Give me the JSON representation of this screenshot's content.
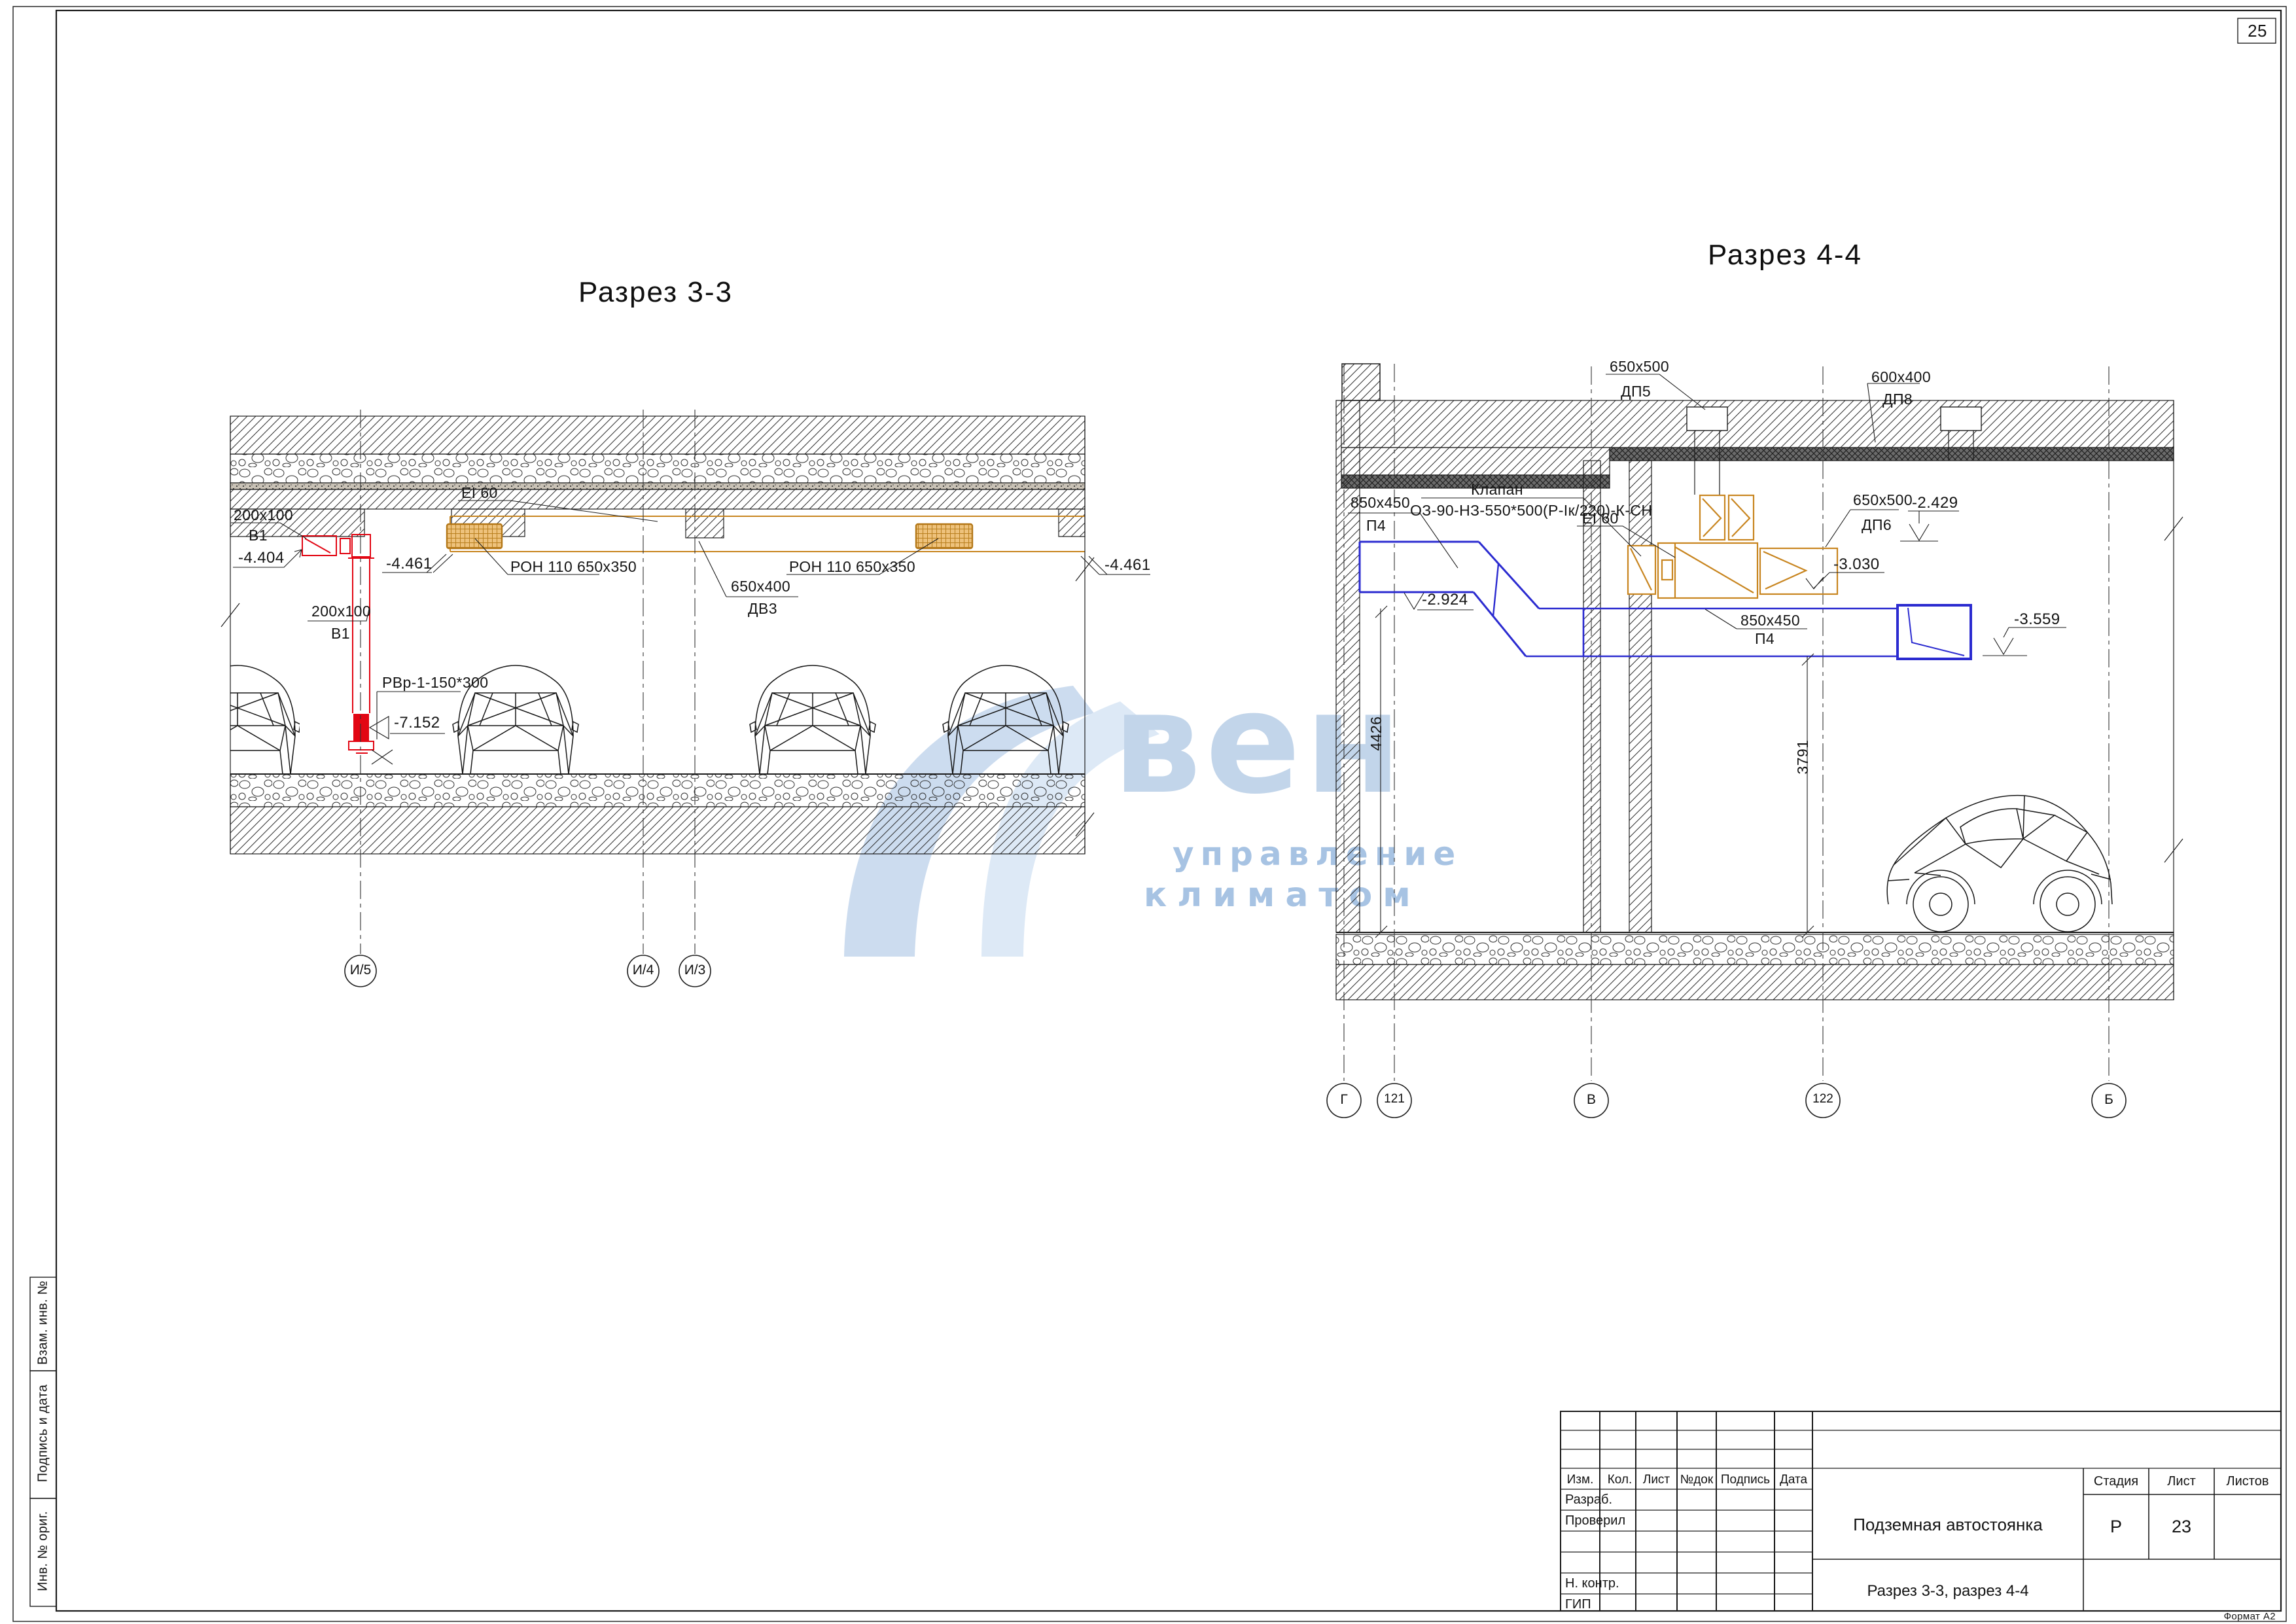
{
  "page": {
    "num": "25",
    "format": "Формат А2"
  },
  "margin": {
    "items": [
      "Взам. инв. №",
      "Подпись и дата",
      "Инв. № ориг."
    ]
  },
  "watermark": {
    "big": "вен",
    "line1": "управление",
    "line2": "климатом"
  },
  "s33": {
    "title": "Разрез 3-3",
    "duct_top_size": "200x100",
    "duct_top_name": "В1",
    "elev_top": "-4.404",
    "elev_left": "-4.461",
    "elev_right": "-4.461",
    "fire_rating": "EI 60",
    "grille1": "РОН 110 650х350",
    "grille2": "РОН 110 650х350",
    "dv3_size": "650х400",
    "dv3_name": "ДВ3",
    "duct_vert_size": "200х100",
    "duct_vert_name": "В1",
    "rvr": "РВр-1-150*300",
    "elev_bottom": "-7.152",
    "axes": [
      "И/5",
      "И/4",
      "И/3"
    ]
  },
  "s44": {
    "title": "Разрез 4-4",
    "dp5_size": "650х500",
    "dp5_name": "ДП5",
    "dp8_size": "600х400",
    "dp8_name": "ДП8",
    "valve_title": "Клапан",
    "valve_spec": "ОЗ-90-НЗ-550*500(Р-Iк/220)-К-СН",
    "p4_top_size": "850х450",
    "p4_top_name": "П4",
    "fire_rating": "EI 60",
    "elev_p4": "-2.924",
    "dp6_size": "650х500",
    "dp6_name": "ДП6",
    "elev_dp6_top": "-2.429",
    "elev_dp6_bottom": "-3.030",
    "elev_duct_end": "-3.559",
    "p4_bottom_size": "850х450",
    "p4_bottom_name": "П4",
    "dim_left": "4426",
    "dim_right": "3791",
    "axes": [
      "Г",
      "121",
      "В",
      "122",
      "Б"
    ]
  },
  "tb": {
    "cols": [
      "Изм.",
      "Кол.",
      "Лист",
      "№док",
      "Подпись",
      "Дата"
    ],
    "r1": "Разраб.",
    "r2": "Проверил",
    "r5": "Н. контр.",
    "r6": "ГИП",
    "project": "Подземная автостоянка",
    "sheet_title": "Разрез 3-3, разрез 4-4",
    "stage_label": "Стадия",
    "list_label": "Лист",
    "lists_label": "Листов",
    "stage": "Р",
    "list_no": "23"
  },
  "colors": {
    "exhaust_red": "#e20613",
    "duct_orange": "#c8851f",
    "supply_blue": "#2b2bd0",
    "watermark_blue": "#b9cfe8"
  }
}
